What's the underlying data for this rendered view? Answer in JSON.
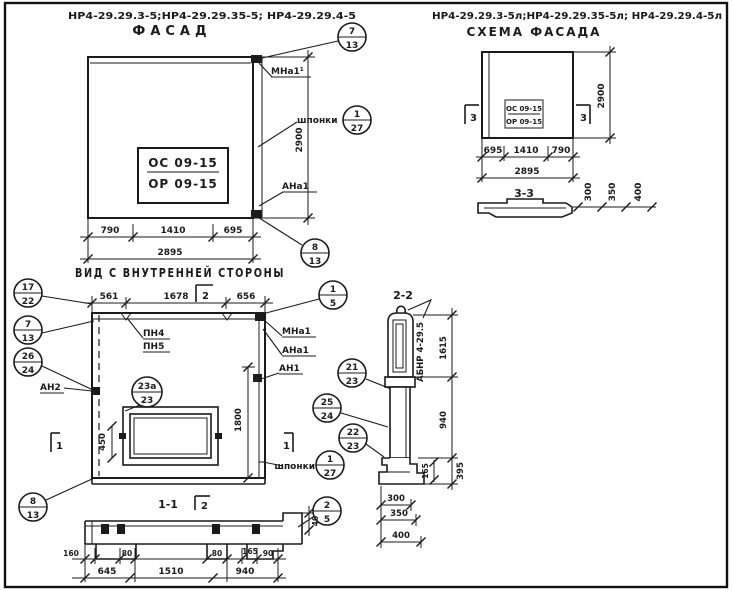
{
  "titles": {
    "facade_codes": "НР4-29.29.3-5;НР4-29.29.35-5; НР4-29.29.4-5",
    "facade": "ФАСАД",
    "schema_codes": "НР4-29.29.3-5л;НР4-29.29.35-5л; НР4-29.29.4-5л",
    "schema": "СХЕМА ФАСАДА",
    "inner_view": "ВИД С ВНУТРЕННЕЙ СТОРОНЫ",
    "s11": "1-1",
    "s22": "2-2",
    "s33": "3-3"
  },
  "stamp": {
    "top": "ОС 09-15",
    "bottom": "ОР 09-15"
  },
  "labels": {
    "mna1_sup": "МНа1¹",
    "mna1": "МНа1",
    "ana1": "АНа1",
    "an1": "АН1",
    "an2": "АН2",
    "pn4": "ПН4",
    "pn5": "ПН5",
    "shponki": "шпонки",
    "abnr": "АБНР 4-29.5"
  },
  "markers": {
    "m1": "1",
    "m2": "2",
    "m3": "3"
  },
  "callouts": {
    "c7_13": {
      "t": "7",
      "b": "13"
    },
    "c8_13": {
      "t": "8",
      "b": "13"
    },
    "c1_27": {
      "t": "1",
      "b": "27"
    },
    "c17_22": {
      "t": "17",
      "b": "22"
    },
    "c26_24": {
      "t": "26",
      "b": "24"
    },
    "c23a_23": {
      "t": "23а",
      "b": "23"
    },
    "c1_5": {
      "t": "1",
      "b": "5"
    },
    "c21_23": {
      "t": "21",
      "b": "23"
    },
    "c25_24": {
      "t": "25",
      "b": "24"
    },
    "c22_23": {
      "t": "22",
      "b": "23"
    },
    "c2_5": {
      "t": "2",
      "b": "5"
    }
  },
  "dims": {
    "facade": {
      "a": "790",
      "b": "1410",
      "c": "695",
      "total": "2895",
      "h": "2900"
    },
    "schema": {
      "a": "695",
      "b": "1410",
      "c": "790",
      "total": "2895",
      "h": "2900",
      "t300": "300",
      "t350": "350",
      "t400": "400"
    },
    "inner": {
      "a": "561",
      "b": "1678",
      "c": "656",
      "v450": "450",
      "v1800": "1800"
    },
    "s11": {
      "v40": "40",
      "a160": "160",
      "a80": "80",
      "b80": "80",
      "a165": "165",
      "a90": "90",
      "b645": "645",
      "b1510": "1510",
      "b940": "940"
    },
    "s22": {
      "h1615": "1615",
      "h940": "940",
      "h395": "395",
      "h165": "165",
      "t300": "300",
      "t350": "350",
      "t400": "400"
    }
  }
}
